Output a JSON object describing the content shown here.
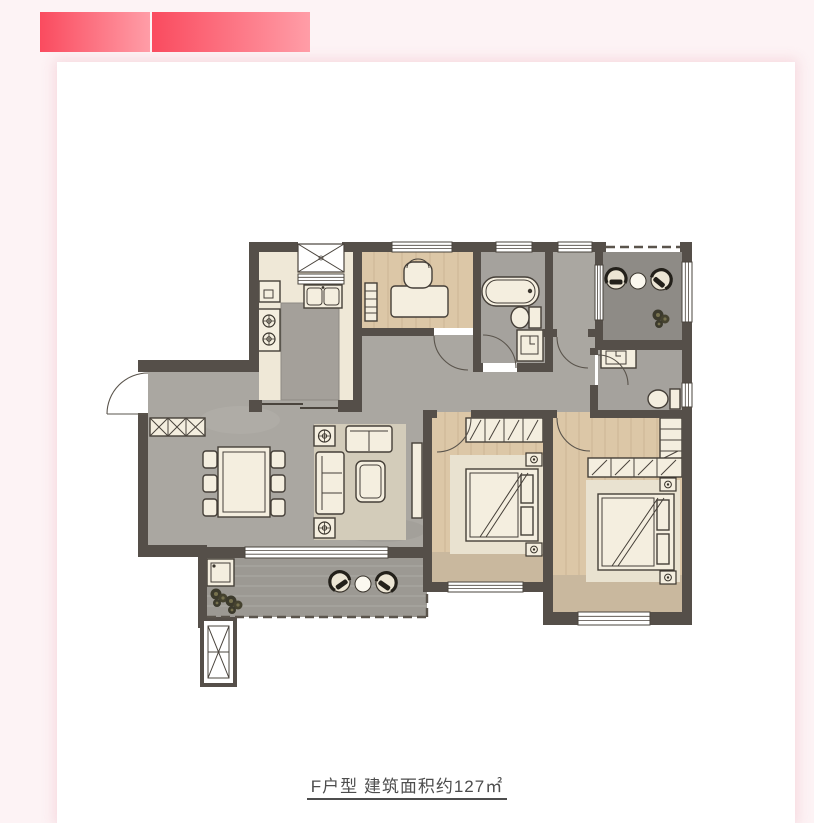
{
  "page": {
    "background": "#fdf3f5",
    "card_background": "#ffffff"
  },
  "header": {
    "bar_gradient": {
      "from": "#fa4b5f",
      "to": "#ff9da7"
    },
    "bars": [
      {
        "name": "red-bar-left"
      },
      {
        "name": "red-bar-right"
      }
    ]
  },
  "floorplan": {
    "caption": "F户型  建筑面积约127㎡",
    "unit_name": "F户型",
    "area_label": "建筑面积约127㎡",
    "area_value_sqm": 127,
    "caption_color": "#4d4d4d",
    "palette": {
      "wall": "#554f49",
      "floor_gray": "#aaa7a1",
      "floor_wood": "#dcc7a7",
      "floor_cream": "#efe8d7",
      "floor_bath": "#a5a29d",
      "balcony_north": "#8e8b86",
      "balcony_south": "#9c9993",
      "furniture_fill": "#f4eedf",
      "furniture_stroke": "#453f38",
      "rug": "#d3ccba",
      "bay": "#c9b89e",
      "island": "#a4a09a"
    },
    "rooms": [
      {
        "name": "entry"
      },
      {
        "name": "living-dining-room"
      },
      {
        "name": "kitchen"
      },
      {
        "name": "study"
      },
      {
        "name": "shared-bathroom"
      },
      {
        "name": "hallway"
      },
      {
        "name": "north-balcony"
      },
      {
        "name": "master-bathroom"
      },
      {
        "name": "second-bedroom"
      },
      {
        "name": "master-bedroom"
      },
      {
        "name": "south-balcony"
      },
      {
        "name": "utility-shaft"
      }
    ],
    "furniture_icons": [
      "entry-door-swing",
      "shoe-cabinet",
      "dining-table",
      "dining-chair",
      "sofa",
      "loveseat",
      "coffee-table",
      "plant-side-table",
      "tv-console",
      "fridge",
      "kitchen-sink",
      "stove",
      "desk",
      "desk-chair",
      "bookshelf",
      "bathtub",
      "toilet",
      "vanity-sink",
      "wardrobe",
      "double-bed",
      "nightstand",
      "washing-machine",
      "outdoor-chair",
      "outdoor-table",
      "plant",
      "window",
      "flue-shaft"
    ]
  }
}
